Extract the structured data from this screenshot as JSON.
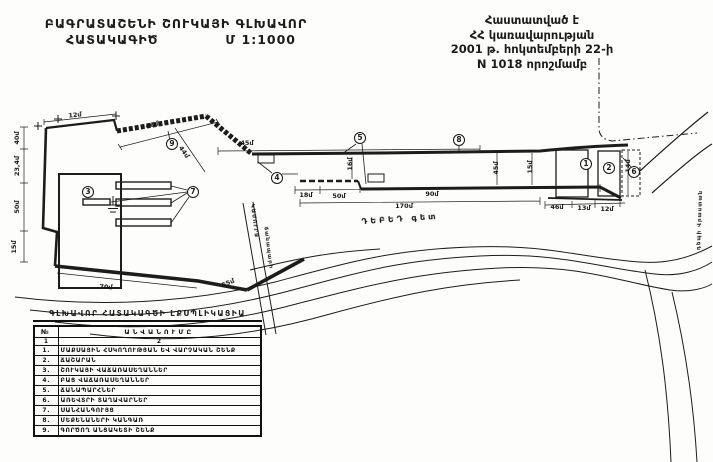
{
  "title_block": {
    "line1": "ԲԱԳՐԱՏԱՇԵՆԻ ՇՈՒԿԱՅԻ ԳԼԽԱՎՈՐ",
    "line2_left": "ՀԱՏԱԿԱԳԻԾ",
    "line2_right": "Մ 1:1000"
  },
  "approval_block": {
    "line1": "Հաստատված է",
    "line2": "ՀՀ կառավարության",
    "line3": "2001 թ. հոկտեմբերի 22-ի",
    "line4": "N 1018 որոշմամբ"
  },
  "plan": {
    "dimensions": [
      {
        "t": "12մ",
        "x": 75,
        "y": 115,
        "r": -5
      },
      {
        "t": "46մ",
        "x": 152,
        "y": 125,
        "r": -14
      },
      {
        "t": "40մ",
        "x": 17,
        "y": 138,
        "r": -90
      },
      {
        "t": "23,4մ",
        "x": 17,
        "y": 166,
        "r": -90
      },
      {
        "t": "50մ",
        "x": 17,
        "y": 207,
        "r": -90
      },
      {
        "t": "15մ",
        "x": 14,
        "y": 247,
        "r": -90
      },
      {
        "t": "44մ",
        "x": 184,
        "y": 152,
        "r": 55
      },
      {
        "t": "45մ",
        "x": 247,
        "y": 143,
        "r": 0
      },
      {
        "t": "18մ",
        "x": 306,
        "y": 195,
        "r": 0
      },
      {
        "t": "50մ",
        "x": 339,
        "y": 196,
        "r": 0
      },
      {
        "t": "90մ",
        "x": 432,
        "y": 194,
        "r": 0
      },
      {
        "t": "170մ",
        "x": 404,
        "y": 206,
        "r": 0
      },
      {
        "t": "16մ",
        "x": 350,
        "y": 164,
        "r": -90
      },
      {
        "t": "70մ",
        "x": 106,
        "y": 287,
        "r": 4
      },
      {
        "t": "55մ",
        "x": 228,
        "y": 283,
        "r": -22
      },
      {
        "t": "45մ",
        "x": 496,
        "y": 168,
        "r": -90
      },
      {
        "t": "15մ",
        "x": 530,
        "y": 167,
        "r": -90
      },
      {
        "t": "14մ",
        "x": 628,
        "y": 166,
        "r": -90
      },
      {
        "t": "46մ",
        "x": 557,
        "y": 207,
        "r": 0
      },
      {
        "t": "13մ",
        "x": 584,
        "y": 208,
        "r": 0
      },
      {
        "t": "12մ",
        "x": 607,
        "y": 209,
        "r": 0
      }
    ],
    "labels": [
      {
        "t": "ԴԵԲԵԴ գետ",
        "x": 400,
        "y": 219,
        "r": -4,
        "s": 8,
        "sp": 3
      },
      {
        "t": "ԿԱՄՈՒՐՋ",
        "x": 254,
        "y": 221,
        "r": 83,
        "s": 5.5,
        "sp": 1
      },
      {
        "t": "ճանապարհ",
        "x": 268,
        "y": 248,
        "r": 83,
        "s": 5.5,
        "sp": 1
      },
      {
        "t": "դեպի Վրաստան",
        "x": 700,
        "y": 220,
        "r": -88,
        "s": 5.5,
        "sp": 1
      }
    ],
    "markers": [
      {
        "n": "3",
        "x": 88,
        "y": 192
      },
      {
        "n": "9",
        "x": 172,
        "y": 144
      },
      {
        "n": "7",
        "x": 193,
        "y": 192
      },
      {
        "n": "4",
        "x": 277,
        "y": 178
      },
      {
        "n": "5",
        "x": 360,
        "y": 138
      },
      {
        "n": "8",
        "x": 459,
        "y": 140
      },
      {
        "n": "1",
        "x": 586,
        "y": 164
      },
      {
        "n": "2",
        "x": 609,
        "y": 168
      },
      {
        "n": "6",
        "x": 634,
        "y": 172
      }
    ]
  },
  "legend": {
    "title": "ԳԼԽԱՎՈՐ ՀԱՏԱԿԱԳԾԻ ԷՔՍՊԼԻԿԱՑԻԱ",
    "col_no": "№",
    "col_name": "ԱՆՎԱՆՈՒՄԸ",
    "sub_no": "1",
    "sub_name": "2",
    "rows": [
      {
        "no": "1.",
        "name": "ՄԱՔՍԱՅԻՆ ՀՍԿՈՂՈՒԹՅԱՆ ԵՎ ՎԱՐՉԱԿԱՆ ՇԵՆՔ"
      },
      {
        "no": "2.",
        "name": "ՃԱՇԱՐԱՆ"
      },
      {
        "no": "3.",
        "name": "ՇՈՒԿԱՅԻ ՎԱՃԱՌԱՍԵՂԱՆՆԵՐ"
      },
      {
        "no": "4.",
        "name": "ԲԱՑ ՎԱՃԱՌԱՍԵՂԱՆՆԵՐ"
      },
      {
        "no": "5.",
        "name": "ՃԱՆԱՊԱՐՀՆԵՐ"
      },
      {
        "no": "6.",
        "name": "ԱՌԵՎՏՐԻ ՏԱՂԱՎԱՐՆԵՐ"
      },
      {
        "no": "7.",
        "name": "ՍԱՆՀԱՆԳՈՒՅՑ"
      },
      {
        "no": "8.",
        "name": "ՄԵՔԵՆԱՆԵՐԻ ԿԱՆԳԱՌ"
      },
      {
        "no": "9.",
        "name": "ԳՈՐԾՈՂ ԱՆՑԱԿԵՏԻ ՇԵՆՔ"
      }
    ]
  }
}
